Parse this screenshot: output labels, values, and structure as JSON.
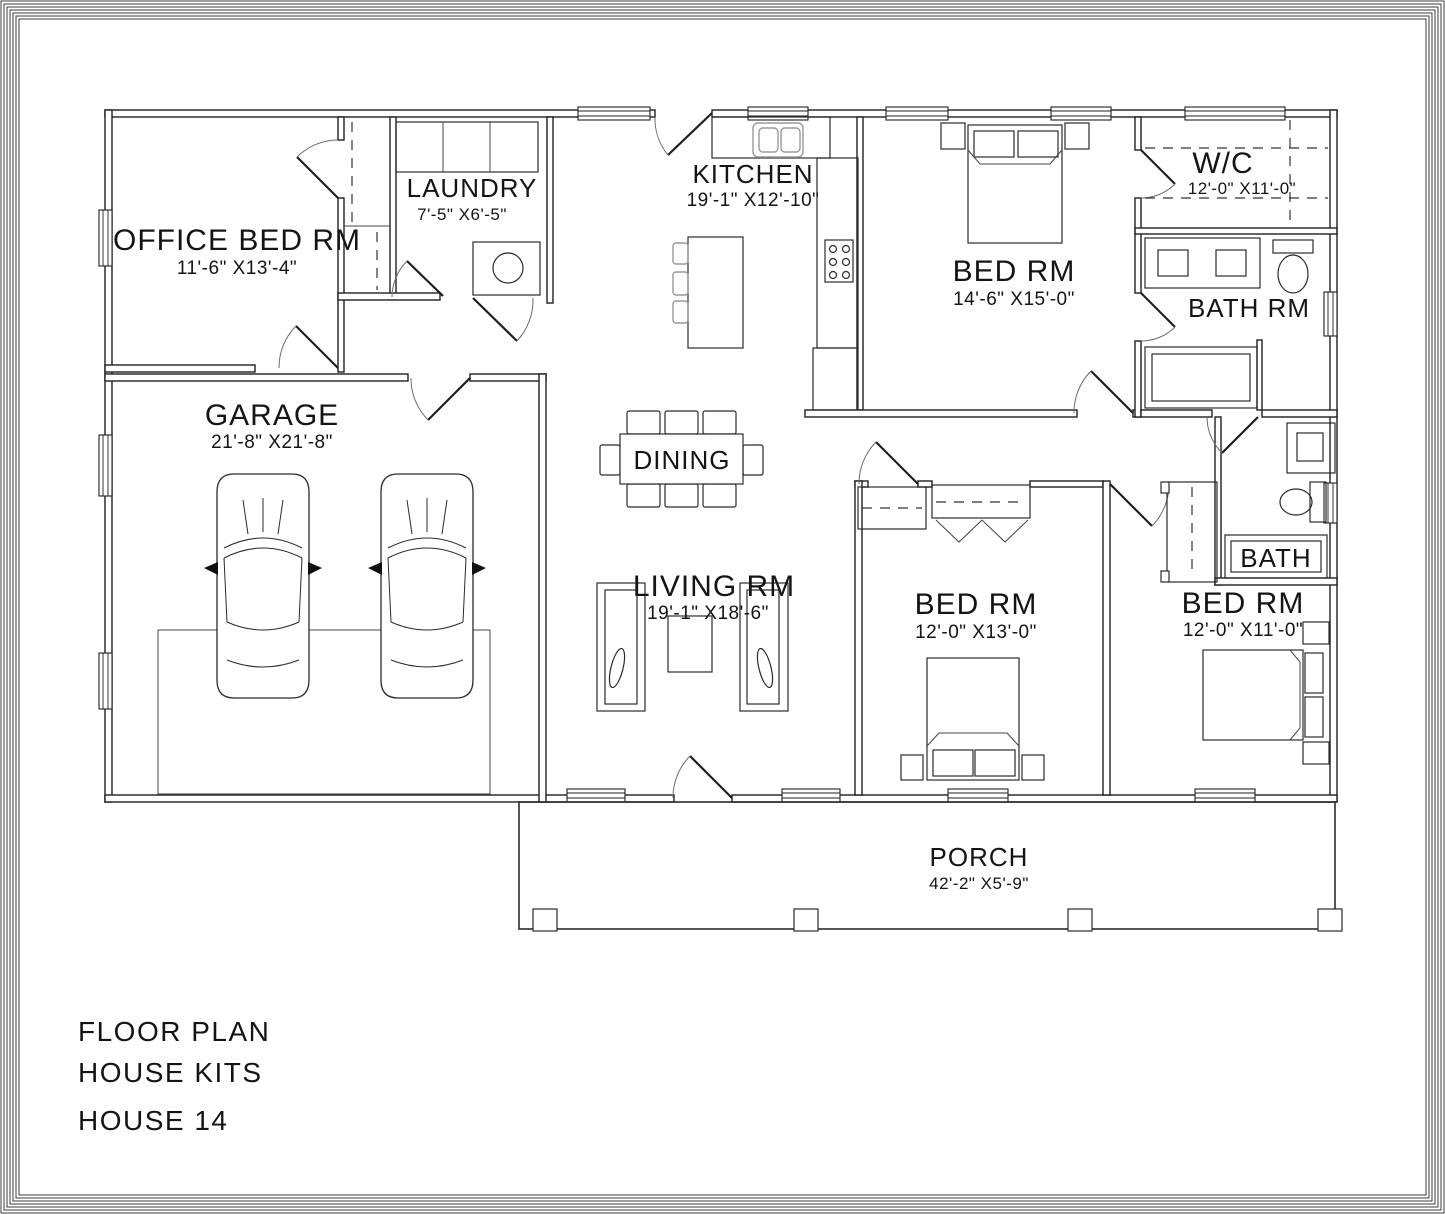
{
  "title_block": {
    "line1": "FLOOR PLAN",
    "line2": "HOUSE KITS",
    "line3": "HOUSE 14"
  },
  "rooms": {
    "office": {
      "name": "OFFICE BED RM",
      "dims": "11'-6\" X13'-4\""
    },
    "laundry": {
      "name": "LAUNDRY",
      "dims": "7'-5\" X6'-5\""
    },
    "kitchen": {
      "name": "KITCHEN",
      "dims": "19'-1\" X12'-10\""
    },
    "bed1": {
      "name": "BED RM",
      "dims": "14'-6\" X15'-0\""
    },
    "wc": {
      "name": "W/C",
      "dims": "12'-0\" X11'-0\""
    },
    "bathrm": {
      "name": "BATH RM"
    },
    "garage": {
      "name": "GARAGE",
      "dims": "21'-8\" X21'-8\""
    },
    "dining": {
      "name": "DINING"
    },
    "living": {
      "name": "LIVING RM",
      "dims": "19'-1\" X18'-6\""
    },
    "bed2": {
      "name": "BED RM",
      "dims": "12'-0\" X13'-0\""
    },
    "bed3": {
      "name": "BED RM",
      "dims": "12'-0\" X11'-0\""
    },
    "bath": {
      "name": "BATH"
    },
    "porch": {
      "name": "PORCH",
      "dims": "42'-2\" X5'-9\""
    }
  },
  "colors": {
    "line": "#1f1f1f",
    "furniture_gray": "#9a9a9a",
    "background": "#ffffff"
  }
}
